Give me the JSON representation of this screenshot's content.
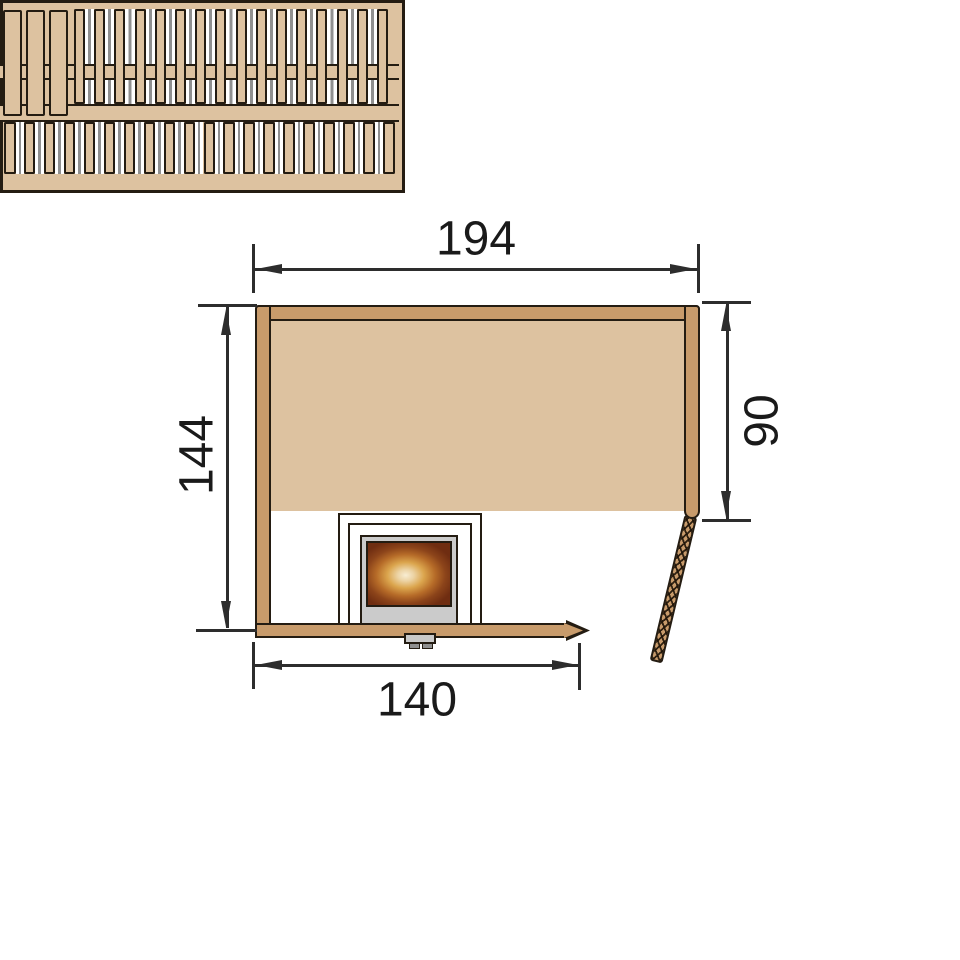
{
  "diagram": {
    "kind": "sauna-floor-plan-top-view",
    "dimensions": {
      "top_width": "194",
      "left_height": "144",
      "right_depth": "90",
      "bottom_door_wall": "140"
    },
    "colors": {
      "wall_wood": "#c89b6b",
      "bench_wood": "#ddc2a0",
      "outline": "#241c12",
      "dimension_line": "#2d2d2d",
      "slat_gap_line": "#909090",
      "heater_frame": "#cbcbcb",
      "heater_glow_center": "#f8edd3",
      "heater_glow_edge": "#6f2d11"
    },
    "benches": {
      "backrest_boards": {
        "count": 3,
        "start": 3,
        "pitch": 23,
        "width": 19
      },
      "upper_slats": {
        "count": 16,
        "start": 74,
        "pitch": 20.2,
        "width": 11
      },
      "lower_slats": {
        "count": 20,
        "start": 4,
        "pitch": 19.95,
        "width": 11.5
      }
    }
  }
}
